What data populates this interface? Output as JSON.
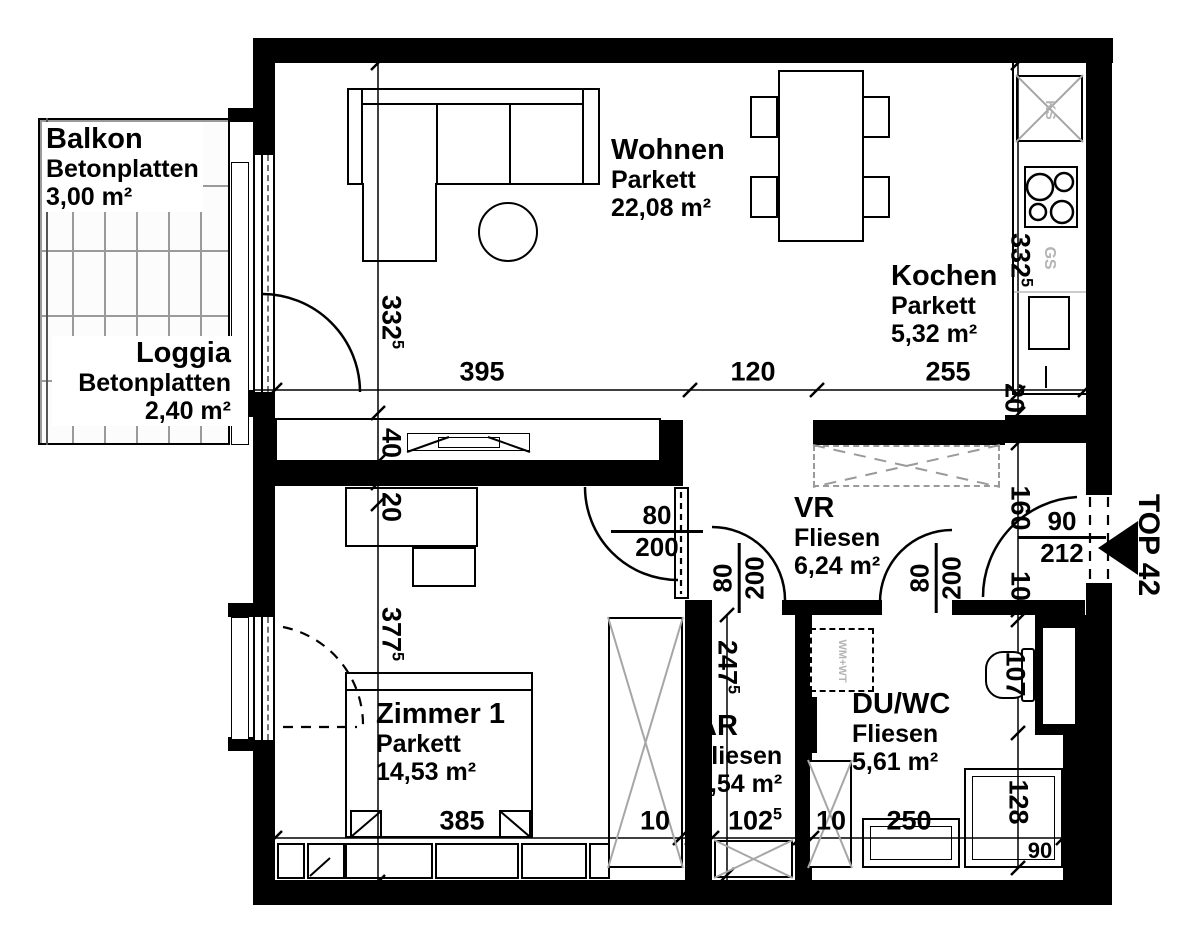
{
  "unit": {
    "label": "TOP 42"
  },
  "rooms": {
    "balkon": {
      "name": "Balkon",
      "floor": "Betonplatten",
      "area": "3,00 m²"
    },
    "loggia": {
      "name": "Loggia",
      "floor": "Betonplatten",
      "area": "2,40 m²"
    },
    "wohnen": {
      "name": "Wohnen",
      "floor": "Parkett",
      "area": "22,08 m²"
    },
    "kochen": {
      "name": "Kochen",
      "floor": "Parkett",
      "area": "5,32 m²"
    },
    "zimmer1": {
      "name": "Zimmer 1",
      "floor": "Parkett",
      "area": "14,53 m²"
    },
    "vr": {
      "name": "VR",
      "floor": "Fliesen",
      "area": "6,24 m²"
    },
    "ar": {
      "name": "AR",
      "floor": "Fliesen",
      "area": "2,54 m²"
    },
    "duwc": {
      "name": "DU/WC",
      "floor": "Fliesen",
      "area": "5,61 m²"
    }
  },
  "dims": {
    "wohnen_width": {
      "v": "395",
      "s": ""
    },
    "passage_width": {
      "v": "120",
      "s": ""
    },
    "kochen_width": {
      "v": "255",
      "s": ""
    },
    "zimmer1_width": {
      "v": "385",
      "s": ""
    },
    "wall_left_of_ar": {
      "v": "10",
      "s": ""
    },
    "ar_width": {
      "v": "102",
      "s": "5"
    },
    "wall_right_of_ar": {
      "v": "10",
      "s": ""
    },
    "duwc_width": {
      "v": "250",
      "s": ""
    },
    "wohnen_depth": {
      "v": "332",
      "s": "5"
    },
    "sideboard_depth": {
      "v": "40",
      "s": ""
    },
    "shelf_depth": {
      "v": "20",
      "s": ""
    },
    "zimmer1_depth": {
      "v": "377",
      "s": "5"
    },
    "kochen_depth": {
      "v": "332",
      "s": "5"
    },
    "counter_gap": {
      "v": "20",
      "s": ""
    },
    "vr_entry_depth": {
      "v": "160",
      "s": ""
    },
    "entry_wall": {
      "v": "10",
      "s": ""
    },
    "wc_depth": {
      "v": "107",
      "s": ""
    },
    "shower_depth": {
      "v": "128",
      "s": ""
    },
    "shower_width": {
      "v": "90",
      "s": ""
    },
    "ar_depth": {
      "v": "247",
      "s": "5"
    }
  },
  "doors": {
    "zimmer1": {
      "w": "80",
      "h": "200"
    },
    "ar": {
      "w": "80",
      "h": "200"
    },
    "duwc": {
      "w": "80",
      "h": "200"
    },
    "entry": {
      "w": "90",
      "h": "212"
    }
  },
  "appliances": {
    "fridge": "KS",
    "dishwasher": "GS",
    "laundry": "WM+WT"
  },
  "colors": {
    "wall": "#000000",
    "furniture_x": "#a6a6a6",
    "appliance_label": "#b4b4b4",
    "tile_grout": "#9a9a9a"
  }
}
